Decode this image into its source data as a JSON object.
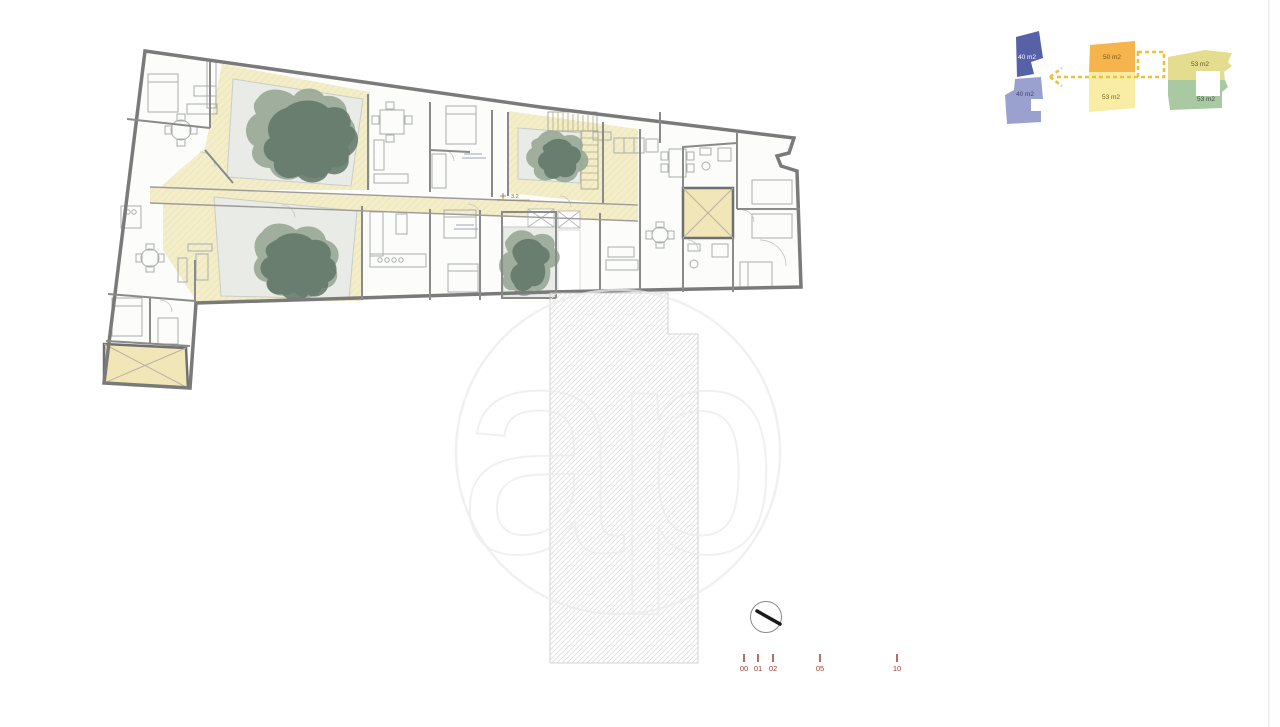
{
  "canvas": {
    "width": 1280,
    "height": 727,
    "background": "#ffffff"
  },
  "watermark": {
    "text": "ap",
    "color": "#ececec"
  },
  "plan": {
    "level_annotation": "3.2",
    "wall_color": "#7a7a7a",
    "terrace_color": "#f3eec9",
    "skylight_color": "#f0e6b8",
    "courtyard_color": "#e9ebe6",
    "tree_color_light": "#97a795",
    "tree_color_dark": "#5f7566"
  },
  "key_plan": {
    "units": [
      {
        "area": "40 m2",
        "color": "#5761a8",
        "text_color": "#ffffff"
      },
      {
        "area": "40 m2",
        "color": "#9ba1cf",
        "text_color": "#3c3f69"
      },
      {
        "area": "50 m2",
        "color": "#f6b44c",
        "text_color": "#7a5213"
      },
      {
        "area": "53 m2",
        "color": "#f9eda6",
        "text_color": "#6e6120"
      },
      {
        "area": "53 m2",
        "color": "#e4dd90",
        "text_color": "#5c5722"
      },
      {
        "area": "53 m2",
        "color": "#a9c9a2",
        "text_color": "#3f4d3a"
      }
    ],
    "arrow_color": "#edbf3e"
  },
  "scale_bar": {
    "labels": [
      "00",
      "01",
      "02",
      "05",
      "10"
    ],
    "color": "#a03a31"
  },
  "compass": {
    "ring_color": "#8a8a8a",
    "needle_color": "#1a1a1a"
  }
}
